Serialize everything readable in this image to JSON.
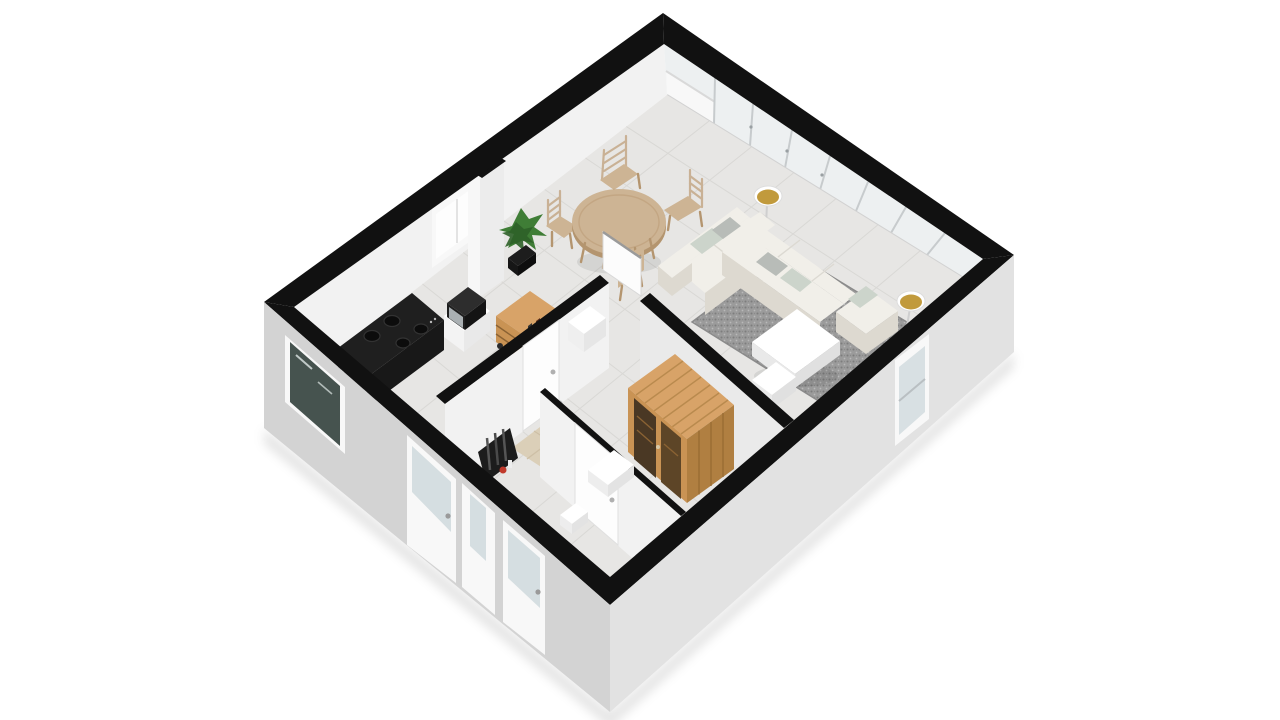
{
  "image": {
    "kind": "3d-floor-plan-render",
    "description": "Isometric 3D cutaway floor plan of a one-bedroom apartment on a white background, walls cut at top and shown as black bands, light gray exterior walls, furnished interior",
    "width": 1280,
    "height": 720
  },
  "palette": {
    "wall_cut": "#111111",
    "ext_wall_sw": "#d3d3d3",
    "ext_wall_se": "#e2e2e2",
    "int_wall": "#f2f2f2",
    "int_wall_shade": "#eaeaea",
    "floor": "#e7e6e4",
    "tile_line": "#d9d8d5",
    "glass": "#edf0f1",
    "glass_teal": "#46534f",
    "glass_door": "#d5dee1",
    "frame_white": "#f8f8f8",
    "mullion": "#c7cbcd",
    "wood": "#d8a368",
    "wood_mid": "#c99354",
    "wood_dark": "#b07f41",
    "wood_frame": "#8a6233",
    "sofa": "#f1efe9",
    "sofa_shade": "#ddd9d0",
    "pillow_gray": "#b8bcb8",
    "pillow_pattern": "#ccd4cb",
    "rug": "#9b9b9b",
    "rug_dark": "#7d7d7d",
    "white": "#ffffff",
    "off_white": "#ececec",
    "appliance_dark": "#1f1f1f",
    "appliance_face": "#2b2b2b",
    "steel": "#aab0b3",
    "table_wood": "#cdb494",
    "table_wood_dark": "#b4956f",
    "chair_wood": "#c9b195",
    "plant_green": "#3f7d36",
    "plant_dark": "#2e6128",
    "pot_black": "#1d1d1d",
    "lamp_gold": "#c19a3c",
    "accent_red": "#c0392b",
    "shadow": "rgba(0,0,0,0.10)"
  },
  "scene": {
    "exterior": {
      "cut_wall_band": "black",
      "sw_wall_openings": [
        "dark-glass-window",
        "glass-front-door",
        "narrow-door",
        "glass-front-door"
      ],
      "se_wall_openings": [
        "tall-window"
      ],
      "ne_wall": "full-height glazing with mullions and folding doors",
      "nw_wall": "white interior face with bright kitchen window"
    },
    "objects": [
      {
        "id": "kitchen-stove",
        "label": "black cooktop counter with stainless oven"
      },
      {
        "id": "microwave-unit",
        "label": "microwave on white cabinet"
      },
      {
        "id": "kitchen-cart",
        "label": "wooden serving cart with shelves"
      },
      {
        "id": "potted-plant",
        "label": "green plant in black pot"
      },
      {
        "id": "duct-column",
        "label": "full-height white column"
      },
      {
        "id": "dining-table",
        "label": "round wooden dining table"
      },
      {
        "id": "dining-chairs",
        "label": "four wooden ladder-back chairs"
      },
      {
        "id": "corner-sofa",
        "label": "white L-shaped sofa with gray pillows"
      },
      {
        "id": "area-rug",
        "label": "gray shag rug"
      },
      {
        "id": "coffee-table",
        "label": "white coffee table"
      },
      {
        "id": "floor-lamps",
        "label": "two floor lamps with gold-lined shades"
      },
      {
        "id": "media-benches",
        "label": "white low benches"
      },
      {
        "id": "sauna",
        "label": "wooden sauna cabin with glass front"
      },
      {
        "id": "shower-floor",
        "label": "beige tiled shower area"
      },
      {
        "id": "radiator-niche",
        "label": "dark niche with radiator and red extinguisher"
      },
      {
        "id": "interior-doors",
        "label": "white doors with metal handles"
      }
    ]
  }
}
